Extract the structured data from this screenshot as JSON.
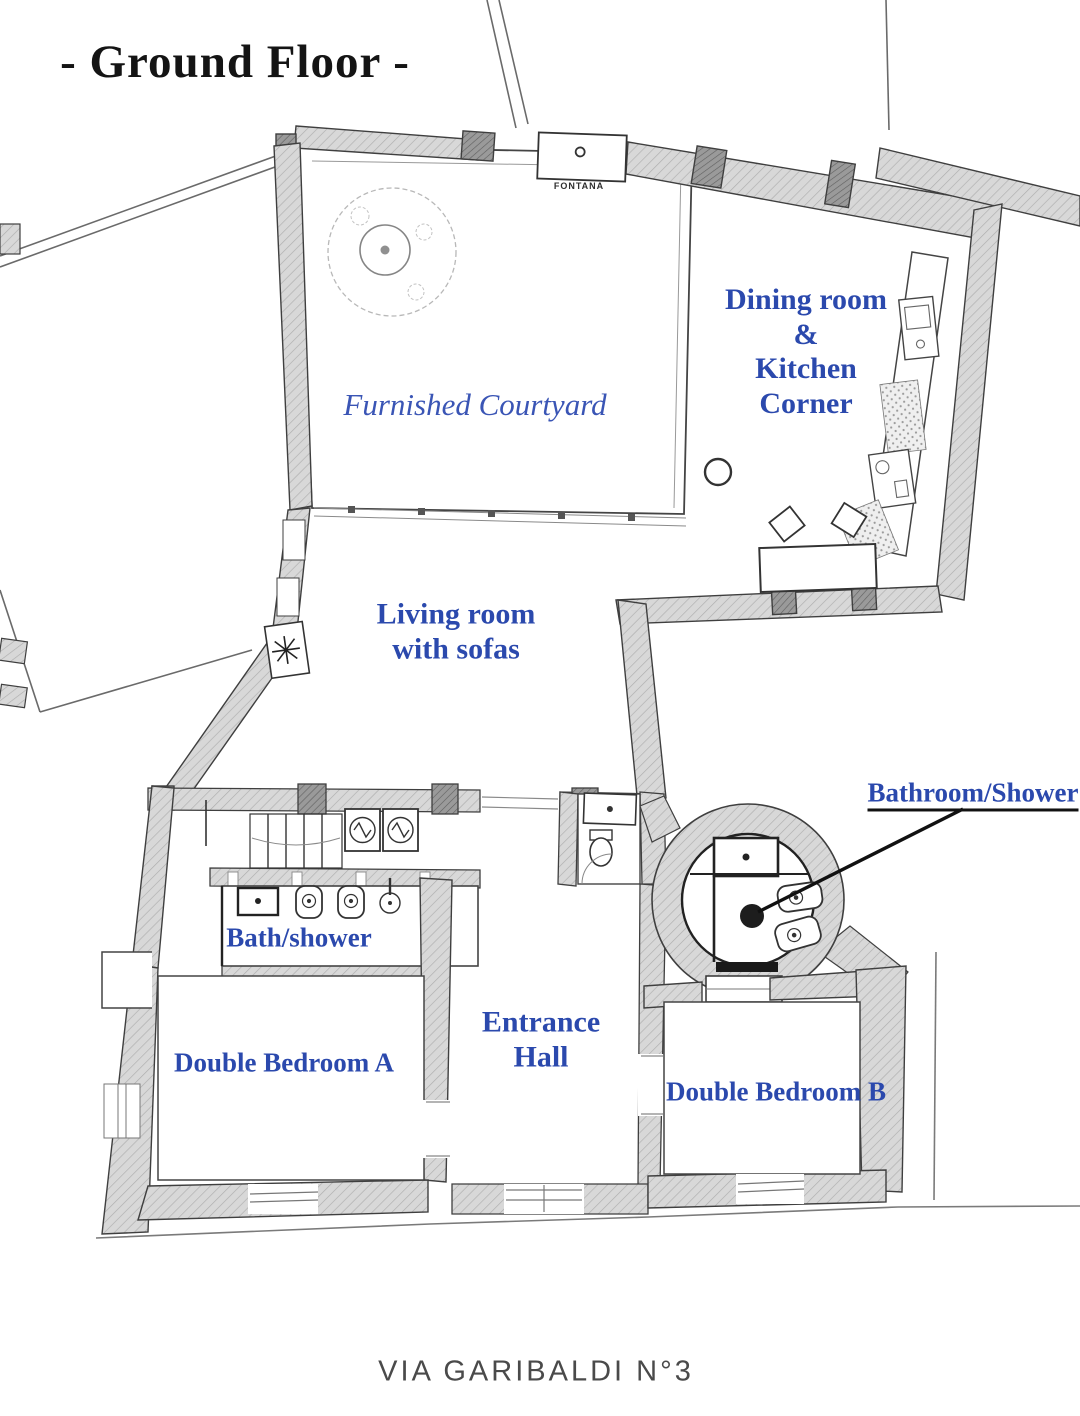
{
  "title": "- Ground Floor -",
  "plan": {
    "rooms": {
      "courtyard": {
        "label": "Furnished Courtyard"
      },
      "dining_kitchen": {
        "lines": [
          "Dining room",
          "&",
          "Kitchen",
          "Corner"
        ]
      },
      "living": {
        "lines": [
          "Living room",
          "with sofas"
        ]
      },
      "round_bathroom": {
        "label": "Bathroom/Shower"
      },
      "bath_shower": {
        "label": "Bath/shower"
      },
      "bedroom_a": {
        "label": "Double Bedroom A"
      },
      "entrance_hall": {
        "lines": [
          "Entrance",
          "Hall"
        ]
      },
      "bedroom_b": {
        "label": "Double Bedroom B"
      }
    },
    "fixtures": {
      "fountain_label": "FONTANA"
    },
    "icons": [
      "tree-icon",
      "fountain-icon",
      "column-icon",
      "kitchen-counter",
      "sink-icon",
      "stove-icon",
      "dining-table-icon",
      "chair-icon",
      "stairs-icon",
      "washing-machine-icon",
      "shower-tray-icon",
      "bidet-icon",
      "toilet-icon",
      "washbasin-icon",
      "door-arc-icon",
      "pointer-arrow"
    ]
  },
  "footer": {
    "street_label": "VIA GARIBALDI N°3"
  },
  "colors": {
    "label_blue": "#2b49ad",
    "courtyard_blue": "#3a55b5",
    "title_black": "#141414",
    "street_gray": "#4a4a4a",
    "wall_fill": "#d8d8d8",
    "wall_hatch": "#aeaeae",
    "wall_dark": "#9a9a9a",
    "wall_stroke": "#3f3f3f",
    "arrow_black": "#111111"
  }
}
